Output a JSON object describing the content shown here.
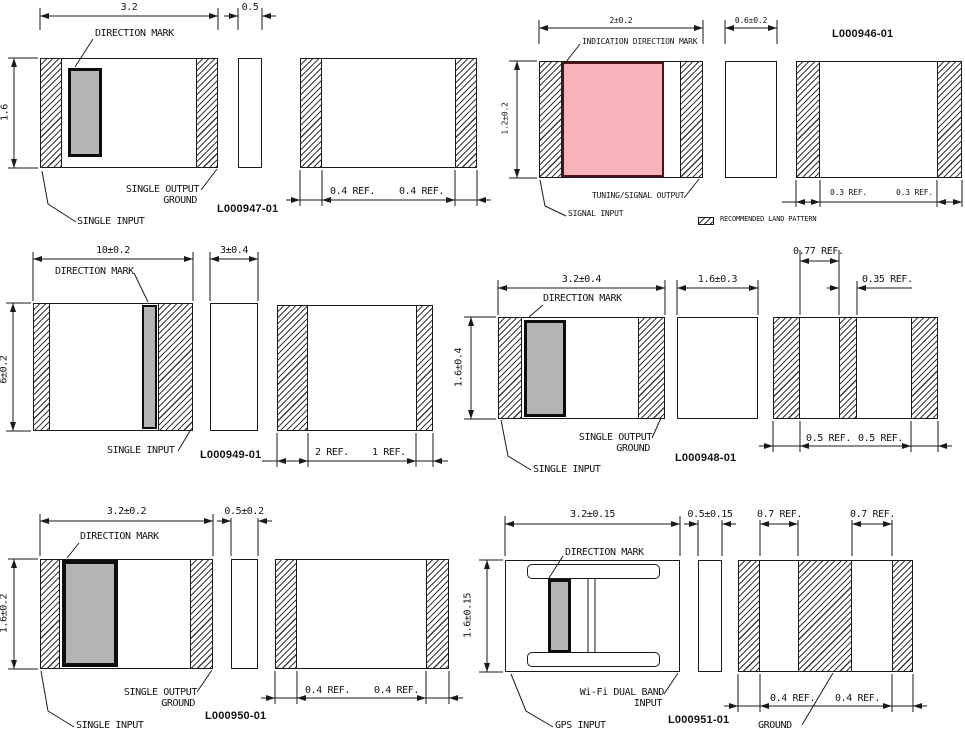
{
  "legend": {
    "label": "RECOMMENDED LAND PATTERN"
  },
  "drawings": {
    "d947": {
      "part": "L000947-01",
      "dim_width": "3.2",
      "dim_side": "0.5",
      "dim_height": "1.6",
      "mark": "DIRECTION MARK",
      "output1": "SINGLE OUTPUT",
      "output2": "GROUND",
      "input": "SINGLE INPUT",
      "land1": "0.4 REF.",
      "land2": "0.4 REF."
    },
    "d946": {
      "part": "L000946-01",
      "dim_width": "2±0.2",
      "dim_side": "0.6±0.2",
      "dim_height": "1.2±0.2",
      "mark": "INDICATION DIRECTION MARK",
      "output": "TUNING/SIGNAL OUTPUT",
      "input": "SIGNAL INPUT",
      "land1": "0.3 REF.",
      "land2": "0.3 REF."
    },
    "d949": {
      "part": "L000949-01",
      "dim_width": "10±0.2",
      "dim_side": "3±0.4",
      "dim_height": "6±0.2",
      "mark": "DIRECTION MARK",
      "input": "SINGLE INPUT",
      "land1": "2 REF.",
      "land2": "1 REF."
    },
    "d948": {
      "part": "L000948-01",
      "dim_width": "3.2±0.4",
      "dim_side": "1.6±0.3",
      "dim_height": "1.6±0.4",
      "mark": "DIRECTION MARK",
      "output1": "SINGLE OUTPUT",
      "output2": "GROUND",
      "input": "SINGLE INPUT",
      "land_top1": "0.77 REF.",
      "land_top2": "0.35 REF.",
      "land1": "0.5 REF.",
      "land2": "0.5 REF."
    },
    "d950": {
      "part": "L000950-01",
      "dim_width": "3.2±0.2",
      "dim_side": "0.5±0.2",
      "dim_height": "1.6±0.2",
      "mark": "DIRECTION MARK",
      "output1": "SINGLE OUTPUT",
      "output2": "GROUND",
      "input": "SINGLE INPUT",
      "land1": "0.4 REF.",
      "land2": "0.4 REF."
    },
    "d951": {
      "part": "L000951-01",
      "dim_width": "3.2±0.15",
      "dim_side": "0.5±0.15",
      "dim_height": "1.6±0.15",
      "mark": "DIRECTION MARK",
      "output1": "Wi-Fi DUAL BAND",
      "output2": "INPUT",
      "input": "GPS INPUT",
      "ground": "GROUND",
      "land_top1": "0.7 REF.",
      "land_top2": "0.7 REF.",
      "land1": "0.4 REF.",
      "land2": "0.4 REF."
    }
  }
}
